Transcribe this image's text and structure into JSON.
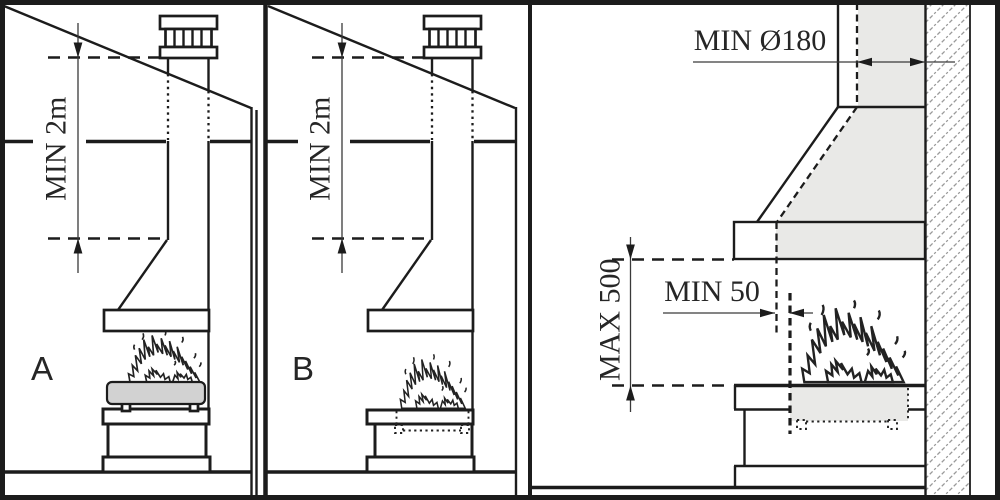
{
  "panel_a": {
    "label": "A",
    "chimney_height_dimension": "MIN 2m"
  },
  "panel_b": {
    "label": "B",
    "chimney_height_dimension": "MIN 2m"
  },
  "detail_panel": {
    "flue_diameter_dimension": "MIN Ø180",
    "hood_to_hearth_dimension": "MAX 500",
    "hood_overhang_dimension": "MIN 50"
  },
  "colors": {
    "line": "#1c1c1c",
    "section_gray": "#e9e9e7",
    "basket_gray": "#d2d2d2",
    "hatch_gray": "#9a9a9a",
    "background": "#ffffff"
  }
}
